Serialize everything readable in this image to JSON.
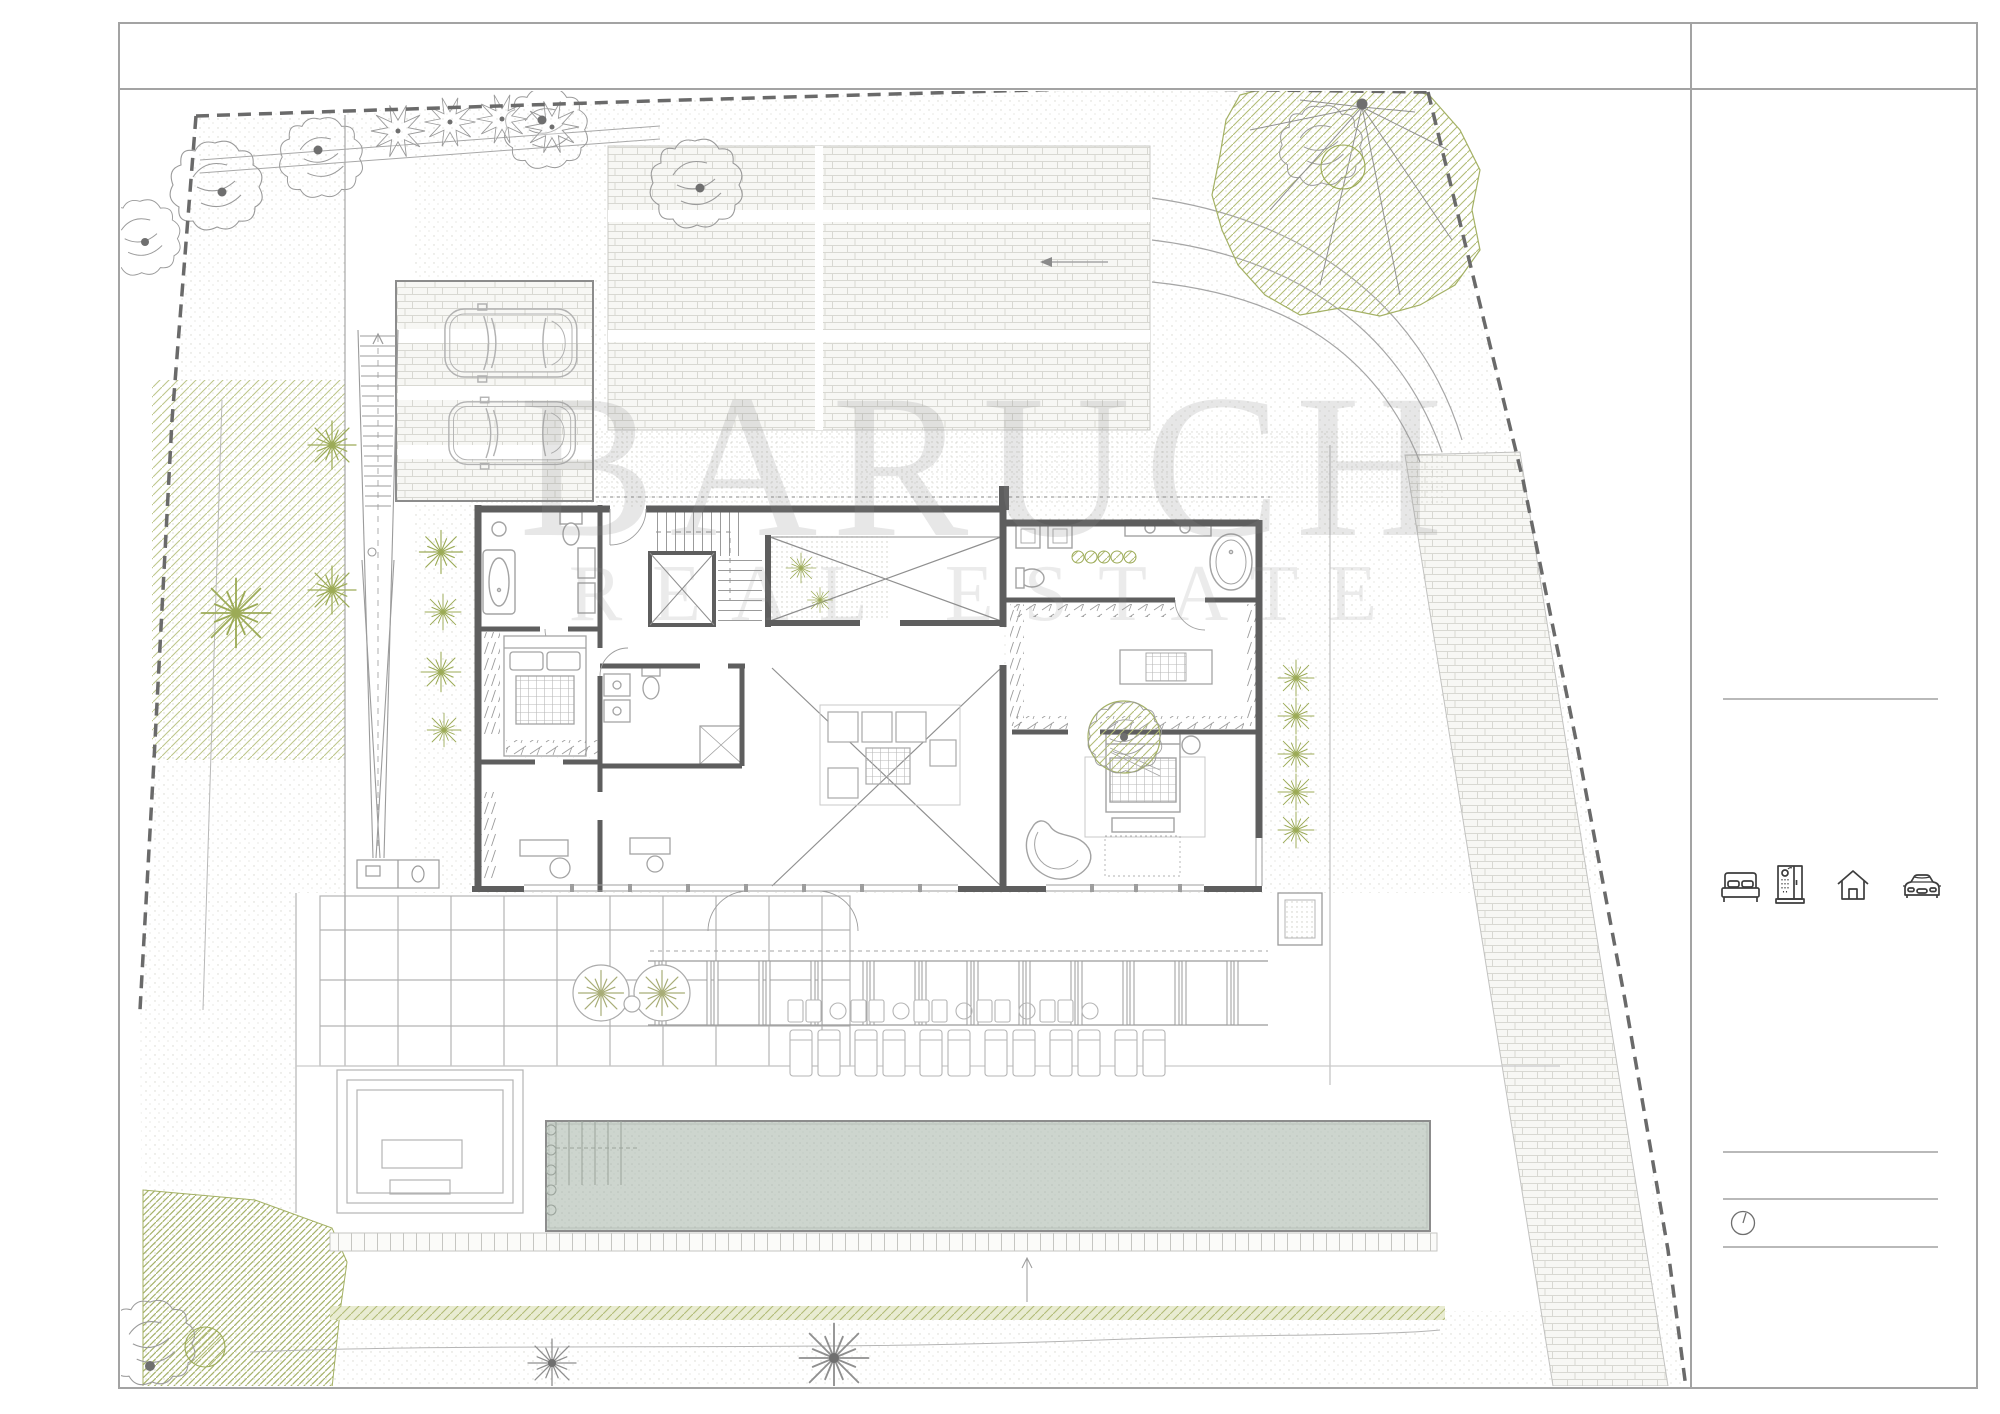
{
  "document": {
    "kind": "architectural site / floor plan sheet",
    "watermark": {
      "line1": "BARUCH",
      "line2": "REAL ESTATE"
    }
  },
  "title_block": {
    "summary_icons": [
      {
        "name": "double-bed-icon"
      },
      {
        "name": "shower-cabin-icon"
      },
      {
        "name": "house-icon"
      },
      {
        "name": "car-icon"
      }
    ],
    "clock_icon": {
      "name": "clock-icon"
    }
  },
  "palette": {
    "paper": "#ffffff",
    "sheet_line": "#a3a3a3",
    "wall": "#5e5e5e",
    "thin_line": "#9b9b9b",
    "green": "#a9b467",
    "green_hatch": "#b2bc77",
    "brick_line": "#d8d8d2",
    "pool_water": "#cdd5ce",
    "boundary_dash": "#6a6a6a",
    "icon_stroke": "#3d3d3d",
    "watermark_gray": "#dadada"
  }
}
